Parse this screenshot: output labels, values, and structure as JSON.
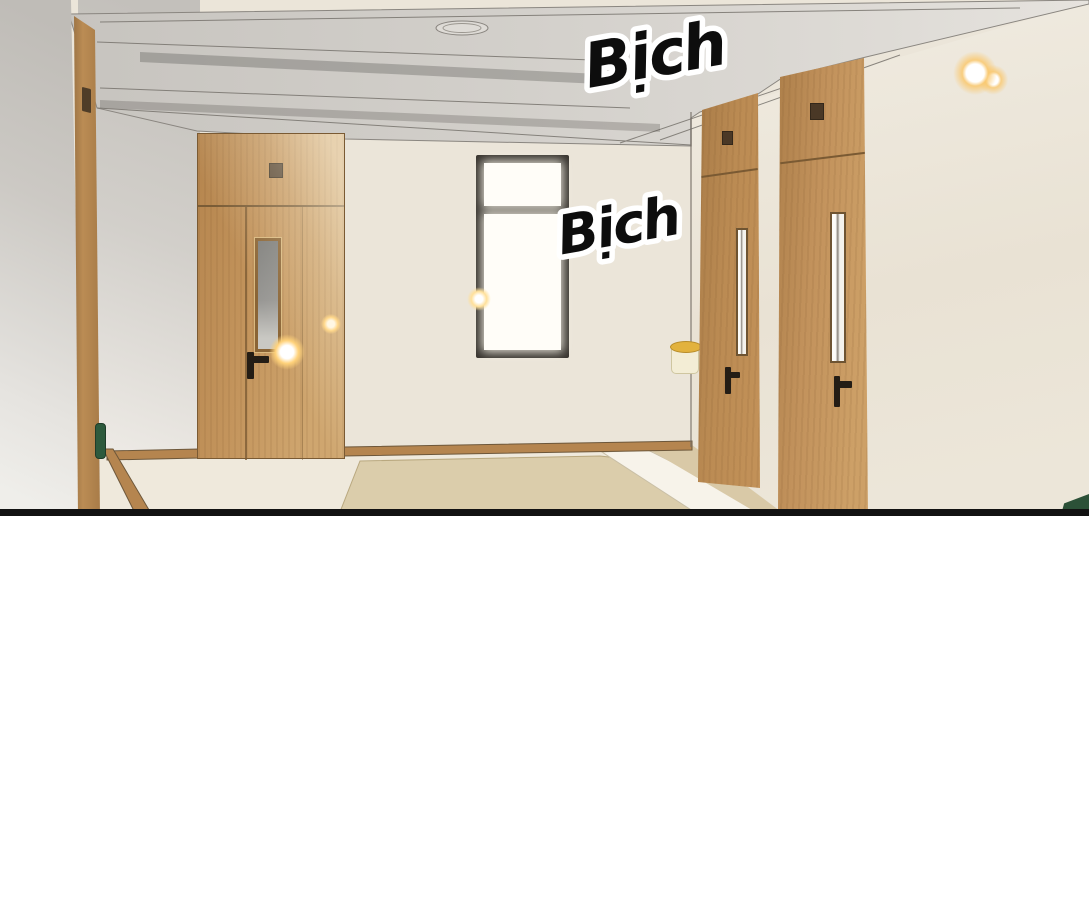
{
  "panel": {
    "kind": "webtoon-hallway-panel",
    "sfx": {
      "top": "Bịch",
      "middle": "Bịch"
    },
    "scene_objects": [
      "left-edge door seen at oblique angle",
      "wooden door with transom and narrow glass slit",
      "black framed window with bright light",
      "wall lamp with gold-rim cream shade",
      "two wooden doors on right receding wall",
      "recessed gray ceiling with downlight",
      "glowing wall light top right",
      "tan floor mat and cream walkway",
      "green sign on left door frame",
      "green object corner bottom right"
    ],
    "colors": {
      "wall_cream": "#ebe5d9",
      "wall_gray": "#c6c3be",
      "ceiling_gray": "#d3d0cb",
      "wood": "#bf8d55",
      "wood_dark": "#7a5a33",
      "window_frame": "#35312c",
      "glass_white": "#fffdf8",
      "floor_cream": "#efe9dc",
      "mat_tan": "#dbcdab",
      "lamp_shade": "#f3edd5",
      "lamp_gold": "#e2b23e",
      "sign_green": "#2d5a3d",
      "glow_orange": "#f5b544",
      "panel_border": "#121212"
    }
  }
}
